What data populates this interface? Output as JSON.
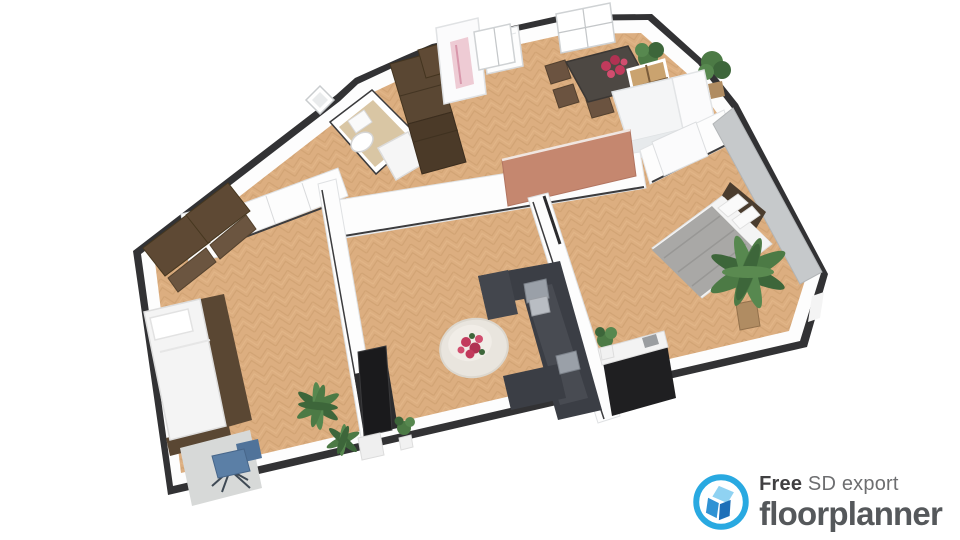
{
  "watermark": {
    "free_label": "Free",
    "export_label": "SD export",
    "brand_label": "floorplanner",
    "icon": "floorplanner-house-icon"
  },
  "colors": {
    "background": "#ffffff",
    "brand_blue": "#29a9e1",
    "logo_house_light": "#8fd2f2",
    "logo_house_mid": "#2f92d4",
    "logo_house_dark": "#1d6fb8",
    "logo_free_text": "#414042",
    "logo_export_text": "#6d6e70",
    "logo_brand_text": "#55585b",
    "wall_outer": "#323234",
    "wall_white": "#fdfdfd",
    "wall_shade": "#e2e4e6",
    "floor_wood": "#dcae80",
    "floor_wood_grain": "#c89a6a",
    "floor_bath": "#d9c6a4",
    "accent_wall_salmon": "#c5876f",
    "accent_wall_gray": "#c6c9cb",
    "sofa_dark": "#3b3e45",
    "pillow_gray": "#9aa0a8",
    "rug_light": "#e9e5de",
    "furniture_wood_dark": "#5a4733",
    "bed_blanket_gray": "#a9a8a6",
    "linen_white": "#f4f4f4",
    "plant_green": "#4c7a45",
    "plant_green_dark": "#3d663a",
    "flower_red": "#c23a5c",
    "office_chair_blue": "#5b7fa6",
    "tv_black": "#1a1a1c",
    "mat_gray": "#d7d9d8",
    "pot_tan": "#b08c62"
  }
}
